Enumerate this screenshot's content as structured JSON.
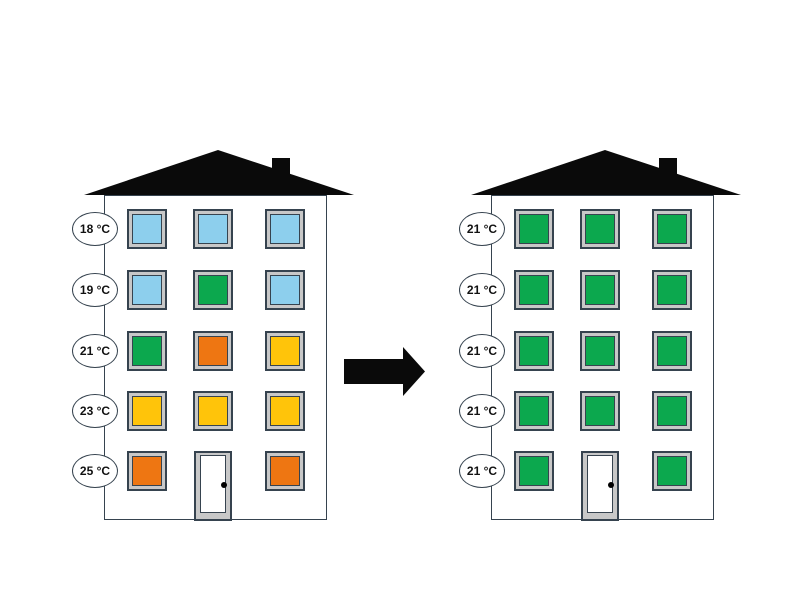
{
  "colors": {
    "blue": "#8DCFED",
    "green": "#0CA84E",
    "orange": "#EE7612",
    "yellow": "#FFC40A",
    "frame_gray": "#C8C8C8",
    "outline_dark": "#36434F",
    "roof_black": "#0A0A0A",
    "door_white": "#FFFFFF",
    "label_bg": "#FFFFFF"
  },
  "arrow": {
    "glyph": "→",
    "direction": "right"
  },
  "buildings": [
    {
      "id": "before",
      "floor_labels": [
        "18 °C",
        "19 °C",
        "21 °C",
        "23 °C",
        "25 °C"
      ],
      "windows": [
        [
          "blue",
          "blue",
          "blue"
        ],
        [
          "blue",
          "green",
          "blue"
        ],
        [
          "green",
          "orange",
          "yellow"
        ],
        [
          "yellow",
          "yellow",
          "yellow"
        ],
        [
          "orange",
          "door",
          "orange"
        ]
      ]
    },
    {
      "id": "after",
      "floor_labels": [
        "21 °C",
        "21 °C",
        "21 °C",
        "21 °C",
        "21 °C"
      ],
      "windows": [
        [
          "green",
          "green",
          "green"
        ],
        [
          "green",
          "green",
          "green"
        ],
        [
          "green",
          "green",
          "green"
        ],
        [
          "green",
          "green",
          "green"
        ],
        [
          "green",
          "door",
          "green"
        ]
      ]
    }
  ]
}
